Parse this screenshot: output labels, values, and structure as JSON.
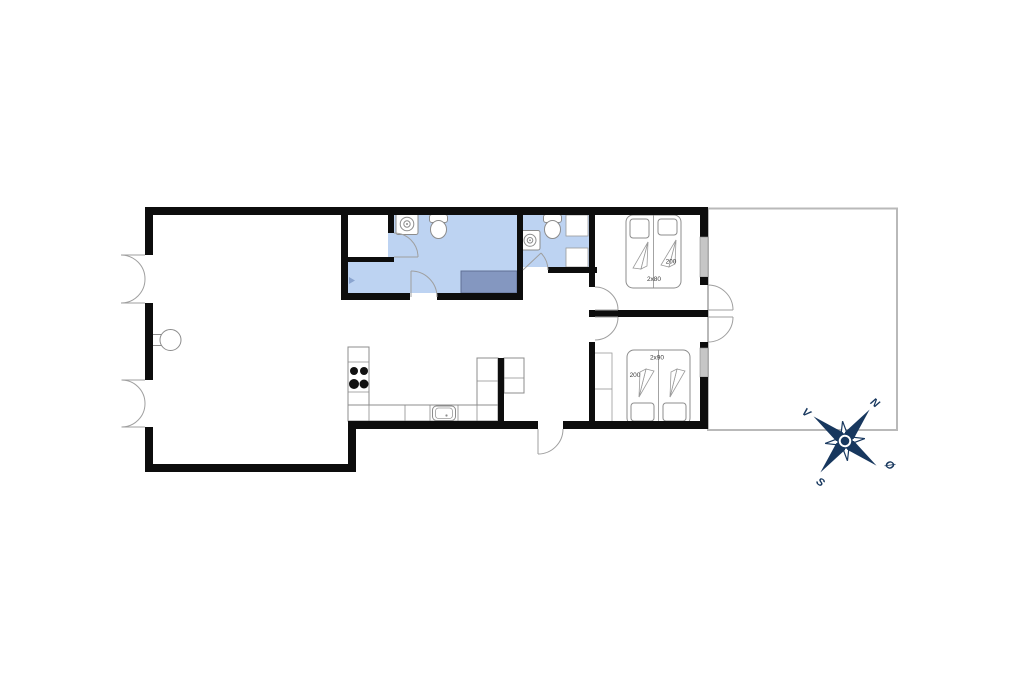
{
  "floorplan": {
    "bedroom1": {
      "bed_length": "200",
      "bed_config": "2x80"
    },
    "bedroom2": {
      "bed_length": "200",
      "bed_config": "2x90"
    },
    "compass": {
      "north": "N",
      "east": "Ø",
      "south": "S",
      "west": "V"
    },
    "colors": {
      "bathroom_floor": "#bdd3f2",
      "shower": "#8497c0",
      "drain": "#8aa4cf",
      "wall": "#0d0d0d",
      "window": "#c6c6c6",
      "terrace_outline": "#b9b9b9",
      "fixture_outline": "#8c8c8c",
      "compass": "#17375e",
      "label": "#3a3a3a"
    }
  }
}
